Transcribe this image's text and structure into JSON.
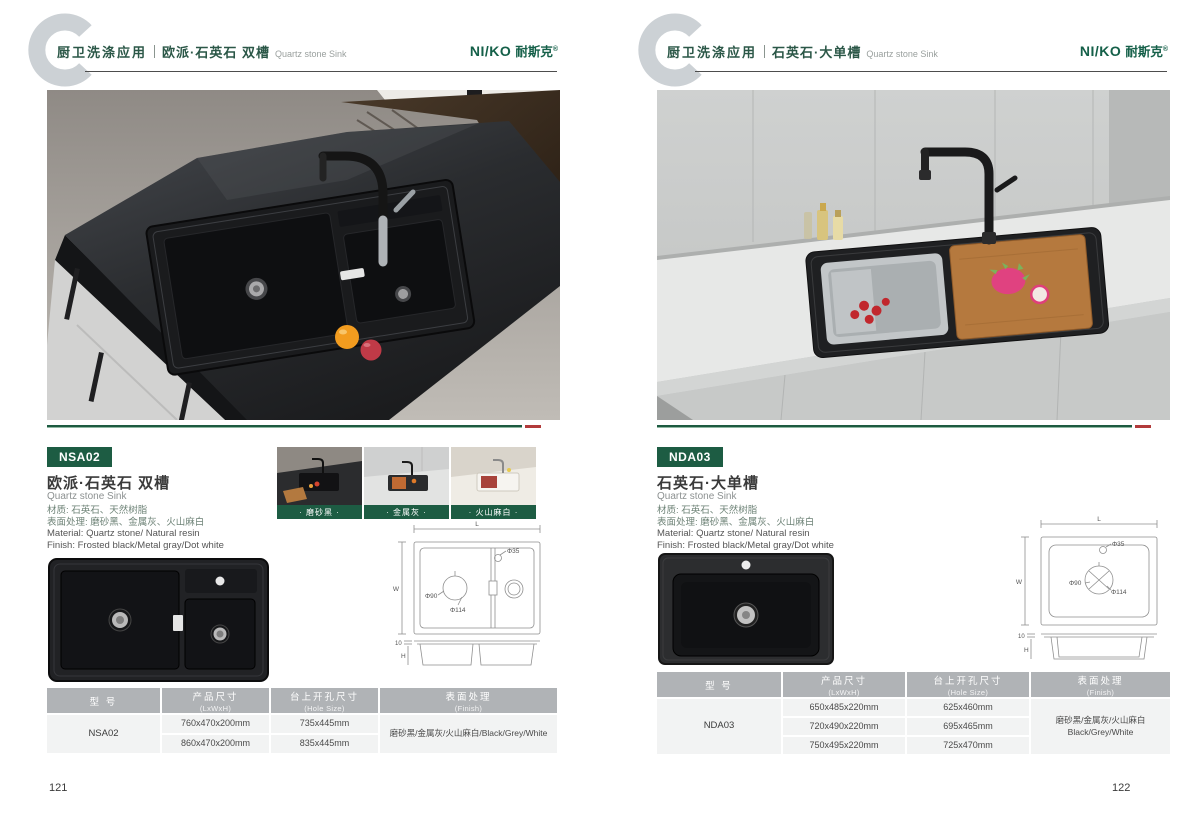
{
  "brand": {
    "latin": "NI/KO",
    "cn": "耐斯克",
    "reg": "®"
  },
  "colors": {
    "brand_green": "#1d5c43",
    "accent_red": "#b23b3b",
    "table_header_gray": "#b0b3b6",
    "logo_gray": "#ccd1d5"
  },
  "drawing_labels": {
    "L": "L",
    "W": "W",
    "H": "H",
    "d35": "Φ35",
    "d90": "Φ90",
    "d114": "Φ114",
    "t10": "10"
  },
  "left_page": {
    "header": {
      "category": "厨卫洗涤应用",
      "product": "欧派·石英石 双槽",
      "product_en": "Quartz stone Sink"
    },
    "model_badge": "NSA02",
    "title": "欧派·石英石 双槽",
    "title_en": "Quartz stone Sink",
    "spec_lines": {
      "cn1": "材质: 石英石、天然树脂",
      "cn2": "表面处理: 磨砂黑、金属灰、火山麻白",
      "en1": "Material: Quartz stone/ Natural resin",
      "en2": "Finish: Frosted black/Metal gray/Dot white"
    },
    "swatches": [
      {
        "label": "· 磨砂黑 ·"
      },
      {
        "label": "· 金属灰 ·"
      },
      {
        "label": "· 火山麻白 ·"
      }
    ],
    "table": {
      "col1": {
        "cn": "型 号"
      },
      "col2": {
        "cn": "产品尺寸",
        "en": "(LxWxH)"
      },
      "col3": {
        "cn": "台上开孔尺寸",
        "en": "(Hole Size)"
      },
      "col4": {
        "cn": "表面处理",
        "en": "(Finish)"
      },
      "model": "NSA02",
      "sizes": [
        "760x470x200mm",
        "860x470x200mm"
      ],
      "holes": [
        "735x445mm",
        "835x445mm"
      ],
      "finish": "磨砂黑/金属灰/火山麻白/Black/Grey/White"
    },
    "page_number": "121"
  },
  "right_page": {
    "header": {
      "category": "厨卫洗涤应用",
      "product": "石英石·大单槽",
      "product_en": "Quartz stone Sink"
    },
    "model_badge": "NDA03",
    "title": "石英石·大单槽",
    "title_en": "Quartz stone Sink",
    "spec_lines": {
      "cn1": "材质: 石英石、天然树脂",
      "cn2": "表面处理: 磨砂黑、金属灰、火山麻白",
      "en1": "Material: Quartz stone/ Natural resin",
      "en2": "Finish: Frosted black/Metal gray/Dot white"
    },
    "table": {
      "col1": {
        "cn": "型 号"
      },
      "col2": {
        "cn": "产品尺寸",
        "en": "(LxWxH)"
      },
      "col3": {
        "cn": "台上开孔尺寸",
        "en": "(Hole Size)"
      },
      "col4": {
        "cn": "表面处理",
        "en": "(Finish)"
      },
      "model": "NDA03",
      "sizes": [
        "650x485x220mm",
        "720x490x220mm",
        "750x495x220mm"
      ],
      "holes": [
        "625x460mm",
        "695x465mm",
        "725x470mm"
      ],
      "finish_cn": "磨砂黑/金属灰/火山麻白",
      "finish_en": "Black/Grey/White"
    },
    "page_number": "122"
  }
}
